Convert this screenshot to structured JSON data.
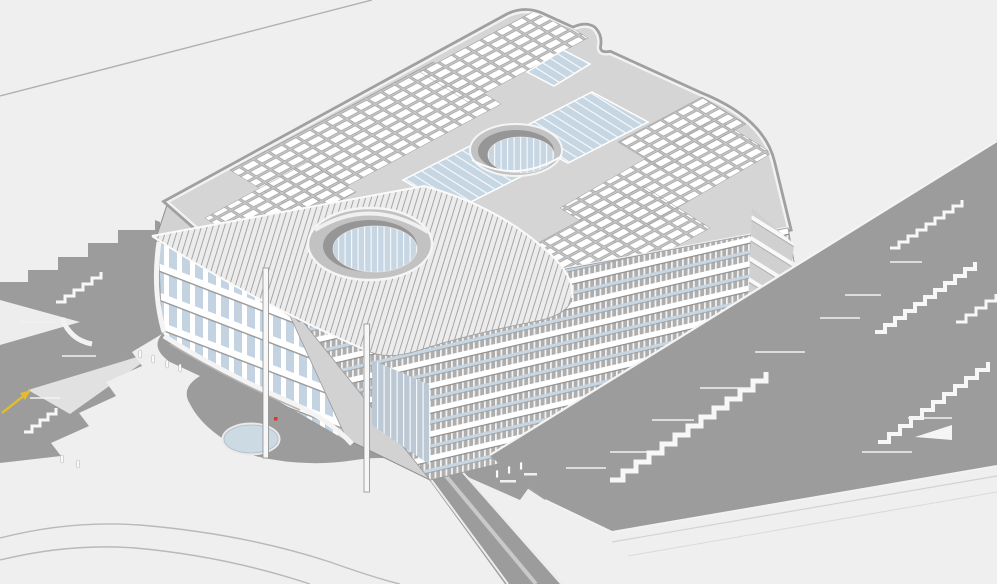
{
  "scene": {
    "view": "aerial-axonometric",
    "subject": "building-site-white-model",
    "width_px": 997,
    "height_px": 584
  },
  "colors": {
    "background": "#efefef",
    "terrain": "#9c9c9c",
    "terrain_light_wedge": "#ededed",
    "building_base": "#d2d2d2",
    "roof": "#d5d5d5",
    "panel_field": "#c4c4c4",
    "panel": "#ffffff",
    "panel_line": "#999999",
    "glass": "#c7d6e3",
    "glass_light": "#f2f6f9",
    "facade": "#aeaeae",
    "floor_band": "#ffffff",
    "wing_glass": "#c3d3e1",
    "ne_facade": "#d0d0d0",
    "canopy": "#ececec",
    "canopy_hatch": "#a6a6a6",
    "column": "#f7f7f7",
    "void_shadow": "#969696",
    "pond": "#ccdae4",
    "pond_rim": "#e9e9e9",
    "stair": "#f7f7f7",
    "path_line": "#bdbdbd",
    "outline": "#8d8d8d",
    "people": "#fcfcfc",
    "arrow": "#e2bb2e",
    "marker": "#e23325"
  },
  "counts": {
    "ponds": 2,
    "canopy_columns": 2,
    "roof_courtyards": 2,
    "stair_flights": 6,
    "people": 9
  }
}
